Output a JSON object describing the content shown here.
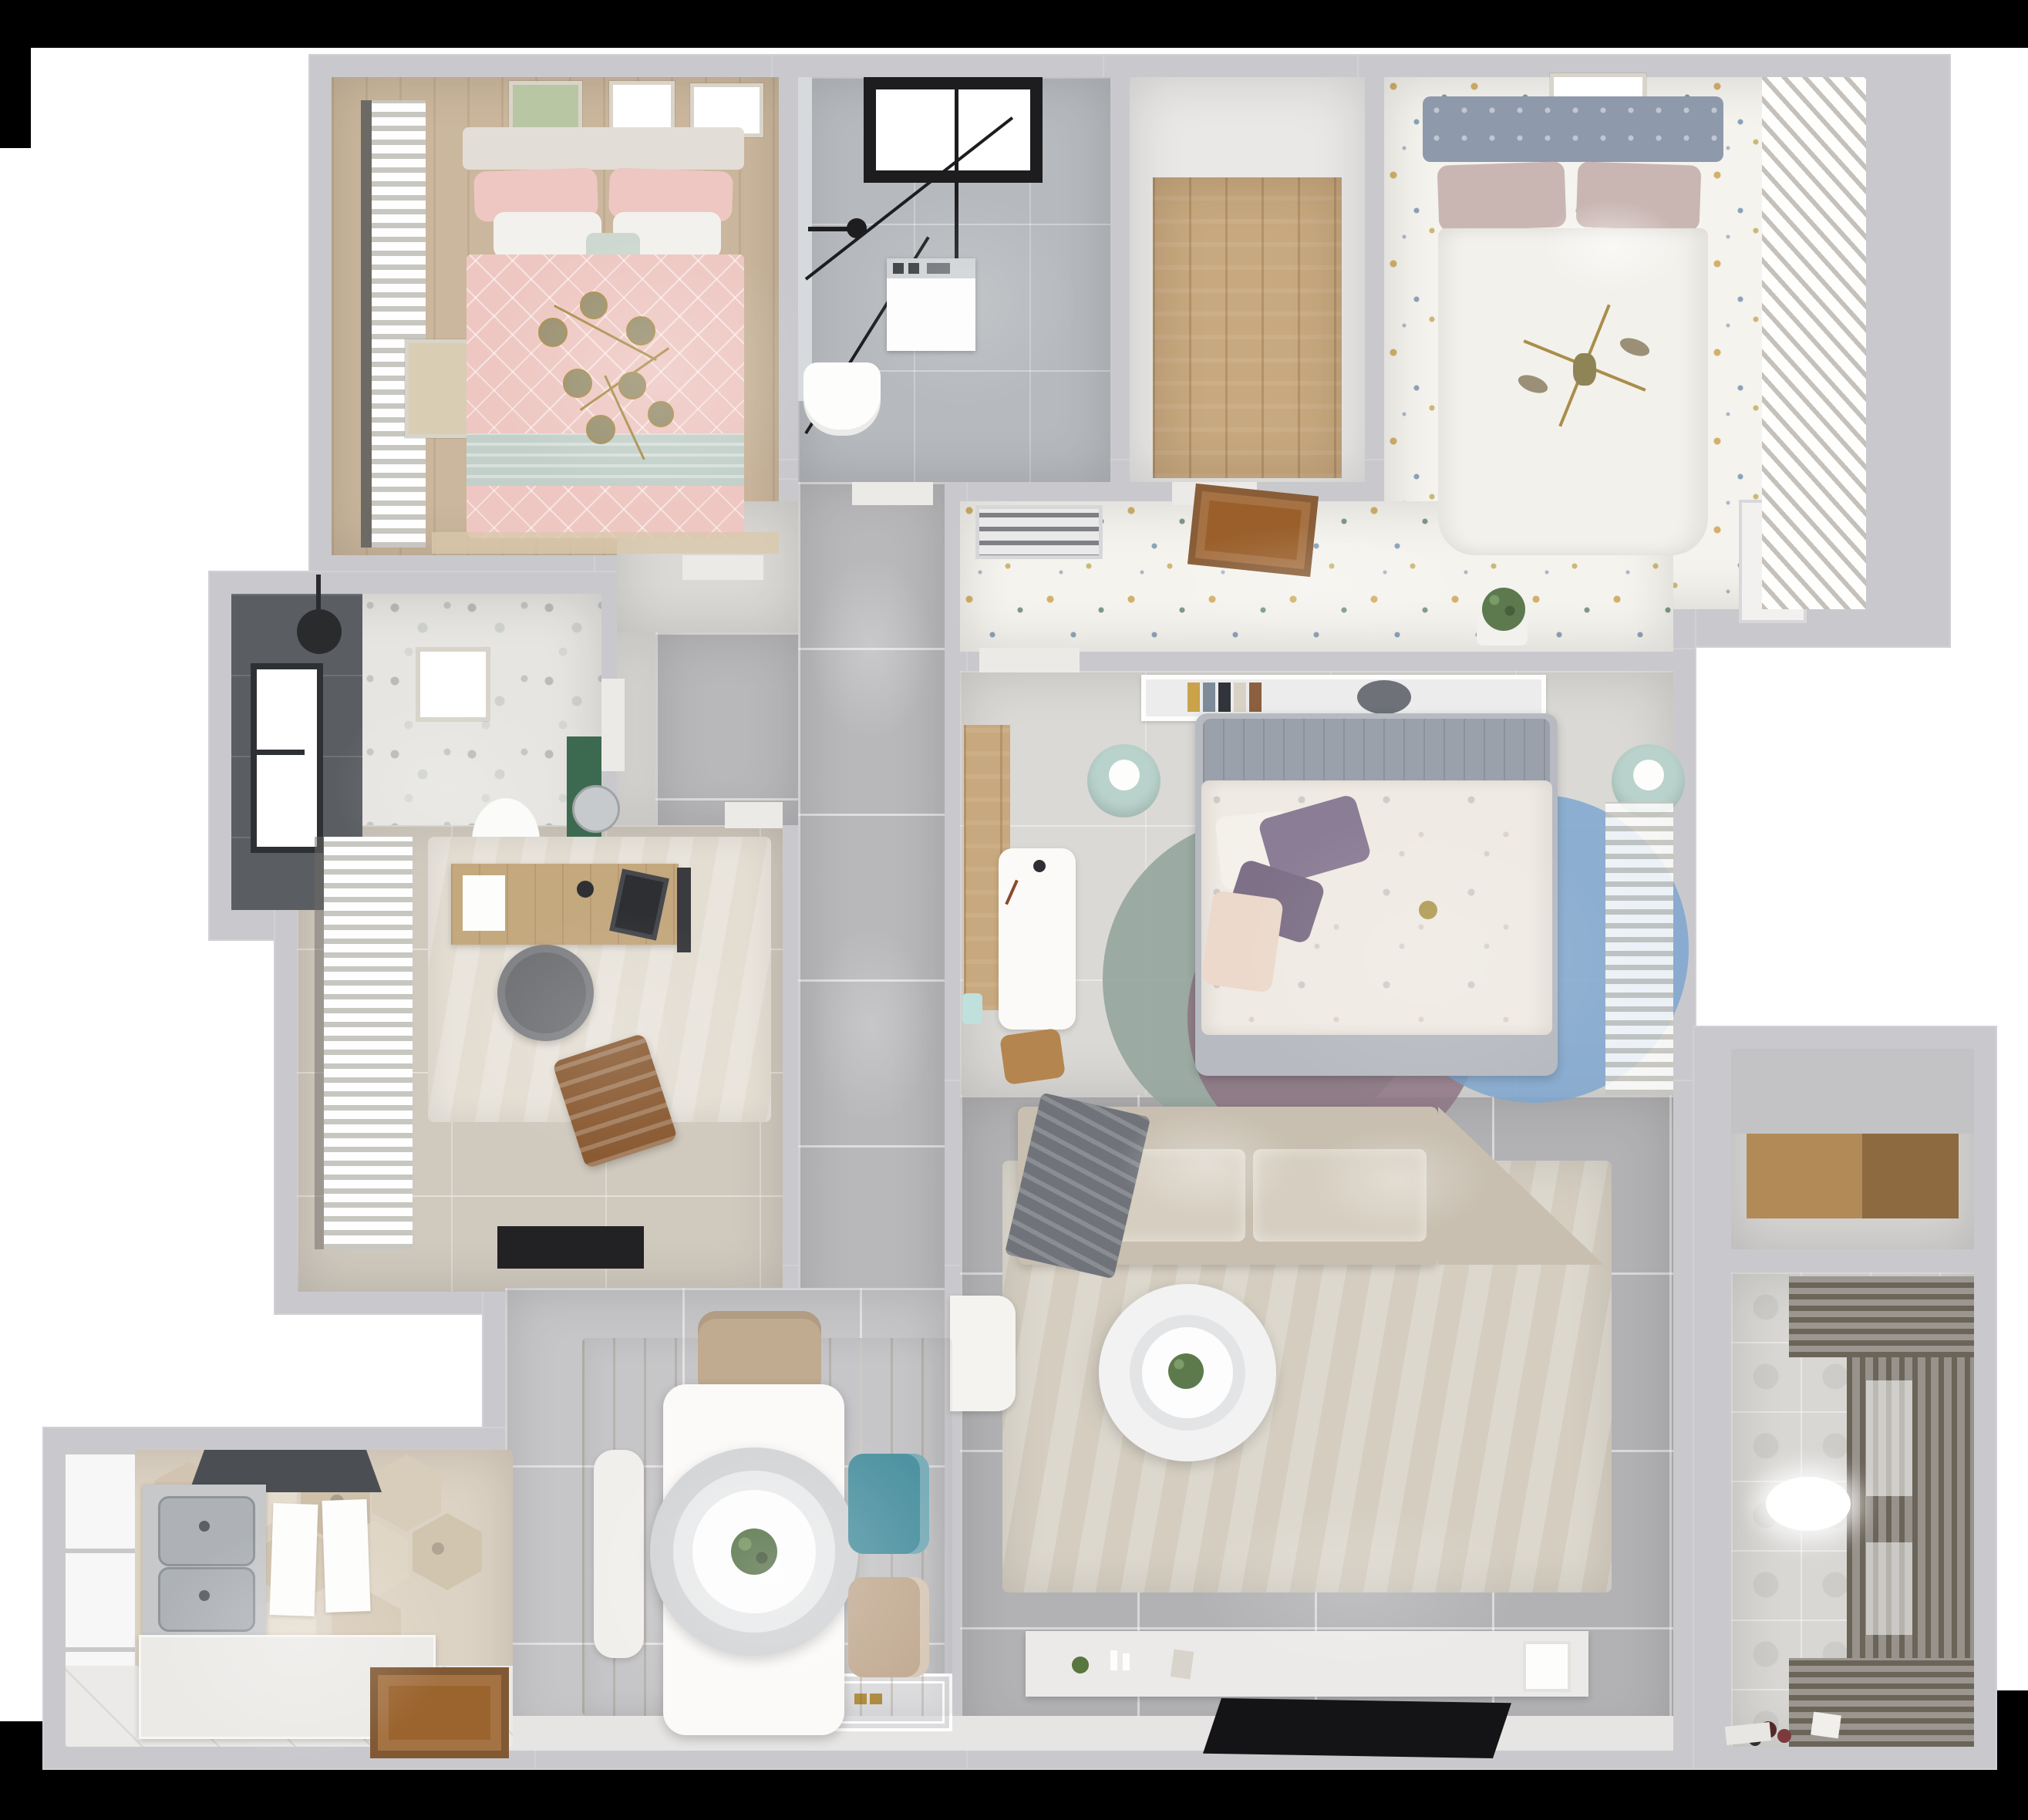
{
  "scene": {
    "type": "3d-floor-plan-top-view",
    "rooms": [
      "bedroom-primary",
      "bathroom-ensuite",
      "walk-in-closet",
      "bedroom-secondary",
      "hallway",
      "corridor",
      "bathroom-guest",
      "study",
      "bedroom-kids",
      "living-room",
      "dining-area",
      "kitchen",
      "storage-nook",
      "balcony-laundry"
    ]
  },
  "palette": {
    "black": "#000000",
    "backdrop": "#ffffff",
    "wall": "#c9c9cd",
    "doorGap": "#eceae7",
    "threshold": "#e6e5e3",
    "corridorTile": "#b8b8ba",
    "livingTile": "#b2b2b4",
    "diningTile": "#c6c6c8",
    "nookFloor": "#dbd9d5",
    "nookStrip": "#e0dedb",
    "confettiBase": "#f5f3ee",
    "confettiGold": "#d3b06a",
    "marble": "#b6b9bd",
    "closetWhite": "#e9e8e6",
    "woodLight": "#c8a87e",
    "hexBase": "#ddd3c4",
    "kitchenWhiteTile": "#ebeae8",
    "counter": "#eceae7",
    "steel": "#aeb2b6",
    "steelEdge": "#8f9499",
    "hood": "#4b4f54",
    "doorWood": "#9b642e",
    "windowWhite": "#f7f7f7",
    "terrazzoBase": "#e7e5e1",
    "bathDark": "#5a5e62",
    "cabinetGreen": "#3c6a50",
    "studyFloor": "#d0c9be",
    "studyRug": "#e3ddd2",
    "deskWood": "#c4a87e",
    "chairGray": "#6f7073",
    "loungeBrown": "#8a5b33",
    "matBlack": "#222224",
    "bed1Head": "#e2ddd6",
    "bed1Pink": "#eec7c2",
    "bed1Mint": "#c3d0c9",
    "rugTan": "#d9c8ac",
    "curtainRod": "#6d6a66",
    "gold": "#a98e4a",
    "oliveKnob": "#99906f",
    "bed2Head": "#8e99ab",
    "bed2Pillow": "#c9b6b2",
    "duvetWhite": "#f3f1ec",
    "shutter": "#f2f0ec",
    "vent": "#e9e9ea",
    "hatchWood": "#9a5f2b",
    "plantGreen": "#5c7a4e",
    "bed3Frame": "#b7bbc1",
    "bed3Head": "#9aa1aa",
    "bed3Duvet": "#efeae3",
    "purple1": "#8b7d95",
    "purple2": "#7d7087",
    "blush": "#ecd9cb",
    "pouf": "#b9d2cc",
    "rugGreen": "#96a69e",
    "rugMauve": "#8d7484",
    "rugBlue": "#7ea6cf",
    "shelfWhite": "#ececec",
    "shelfWoodL": "#b28a58",
    "shelfWoodD": "#8d6a40",
    "storageFloor": "#d6d5d3",
    "storageBand": "#c3c3c6",
    "sofa": "#c8bfb0",
    "cushion": "#d6cec0",
    "throw": "#70747a",
    "rugLiving": "#d4cdc0",
    "console": "#eceae8",
    "tv": "#141416",
    "armWhite": "#f4f3f0",
    "tableWhite": "#fbfaf8",
    "benchWhite": "#f1efec",
    "teal": "#4f93a2",
    "chairBeige": "#c0aa90",
    "chairBeige2": "#c3ac94",
    "pendantOuter": "#d2d3d5",
    "pendantMid": "#e8e9ea",
    "plantDark": "#4e6b3f",
    "balconyFloor": "#d8d7d4",
    "rack": "#6b6459",
    "toyRed": "#7c3a3c",
    "toyDark": "#55282a",
    "glassEdge": "#d7dadd",
    "washerWhite": "#fdfdfd",
    "black2": "#1d1d1f",
    "matGray": "#dcdcde",
    "brassKnob": "#b08d3f"
  }
}
